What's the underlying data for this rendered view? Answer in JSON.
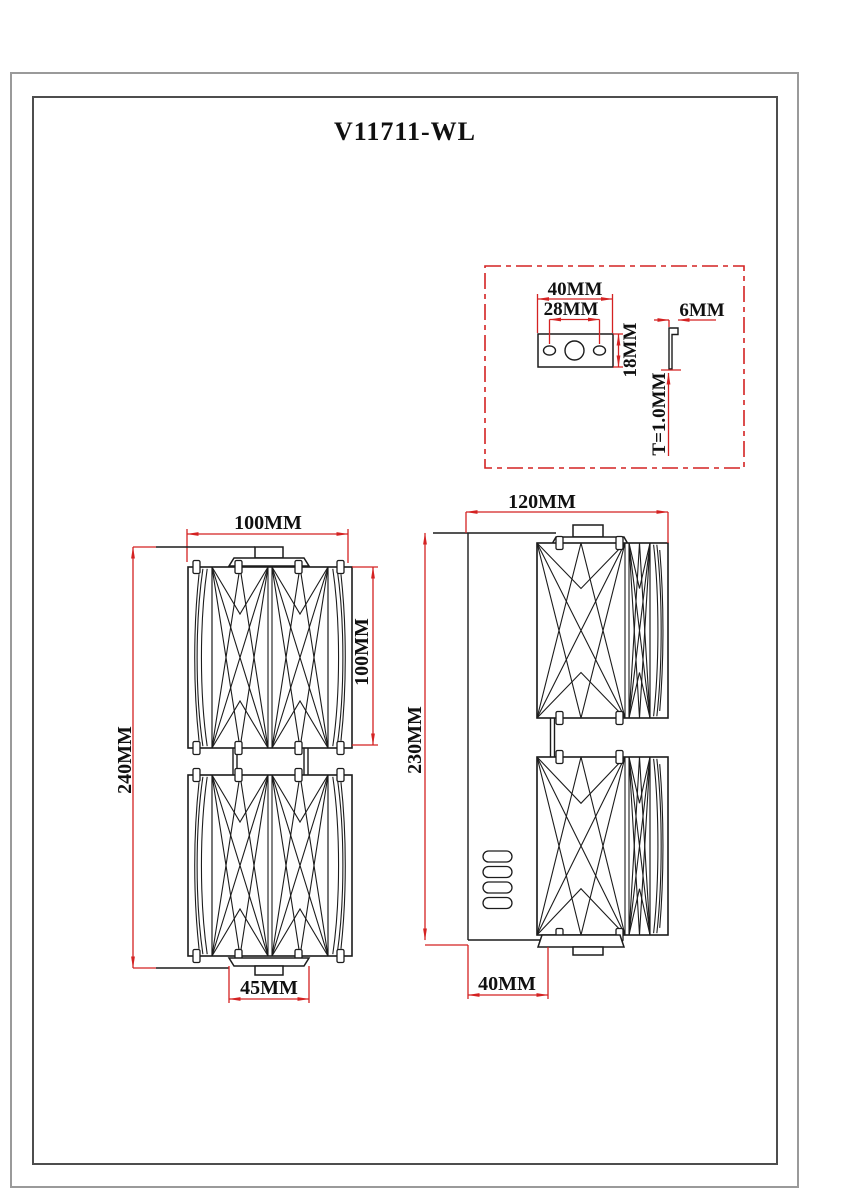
{
  "page": {
    "title": "V11711-WL"
  },
  "bracket_detail": {
    "width_label": "40MM",
    "hole_spacing_label": "28MM",
    "height_label": "18MM",
    "hook_depth_label": "6MM",
    "thickness_label": "T=1.0MM"
  },
  "front_view": {
    "shade_width_label": "100MM",
    "shade_height_label": "100MM",
    "overall_height_label": "240MM",
    "base_width_label": "45MM"
  },
  "side_view": {
    "overall_depth_label": "120MM",
    "backplate_height_label": "230MM",
    "backplate_depth_label": "40MM"
  },
  "colors": {
    "dimension_red": "#d42222",
    "drawing_black": "#1c1c1c",
    "outer_border_gray": "#9a9a9a",
    "inner_border_gray": "#4d4d4d"
  }
}
